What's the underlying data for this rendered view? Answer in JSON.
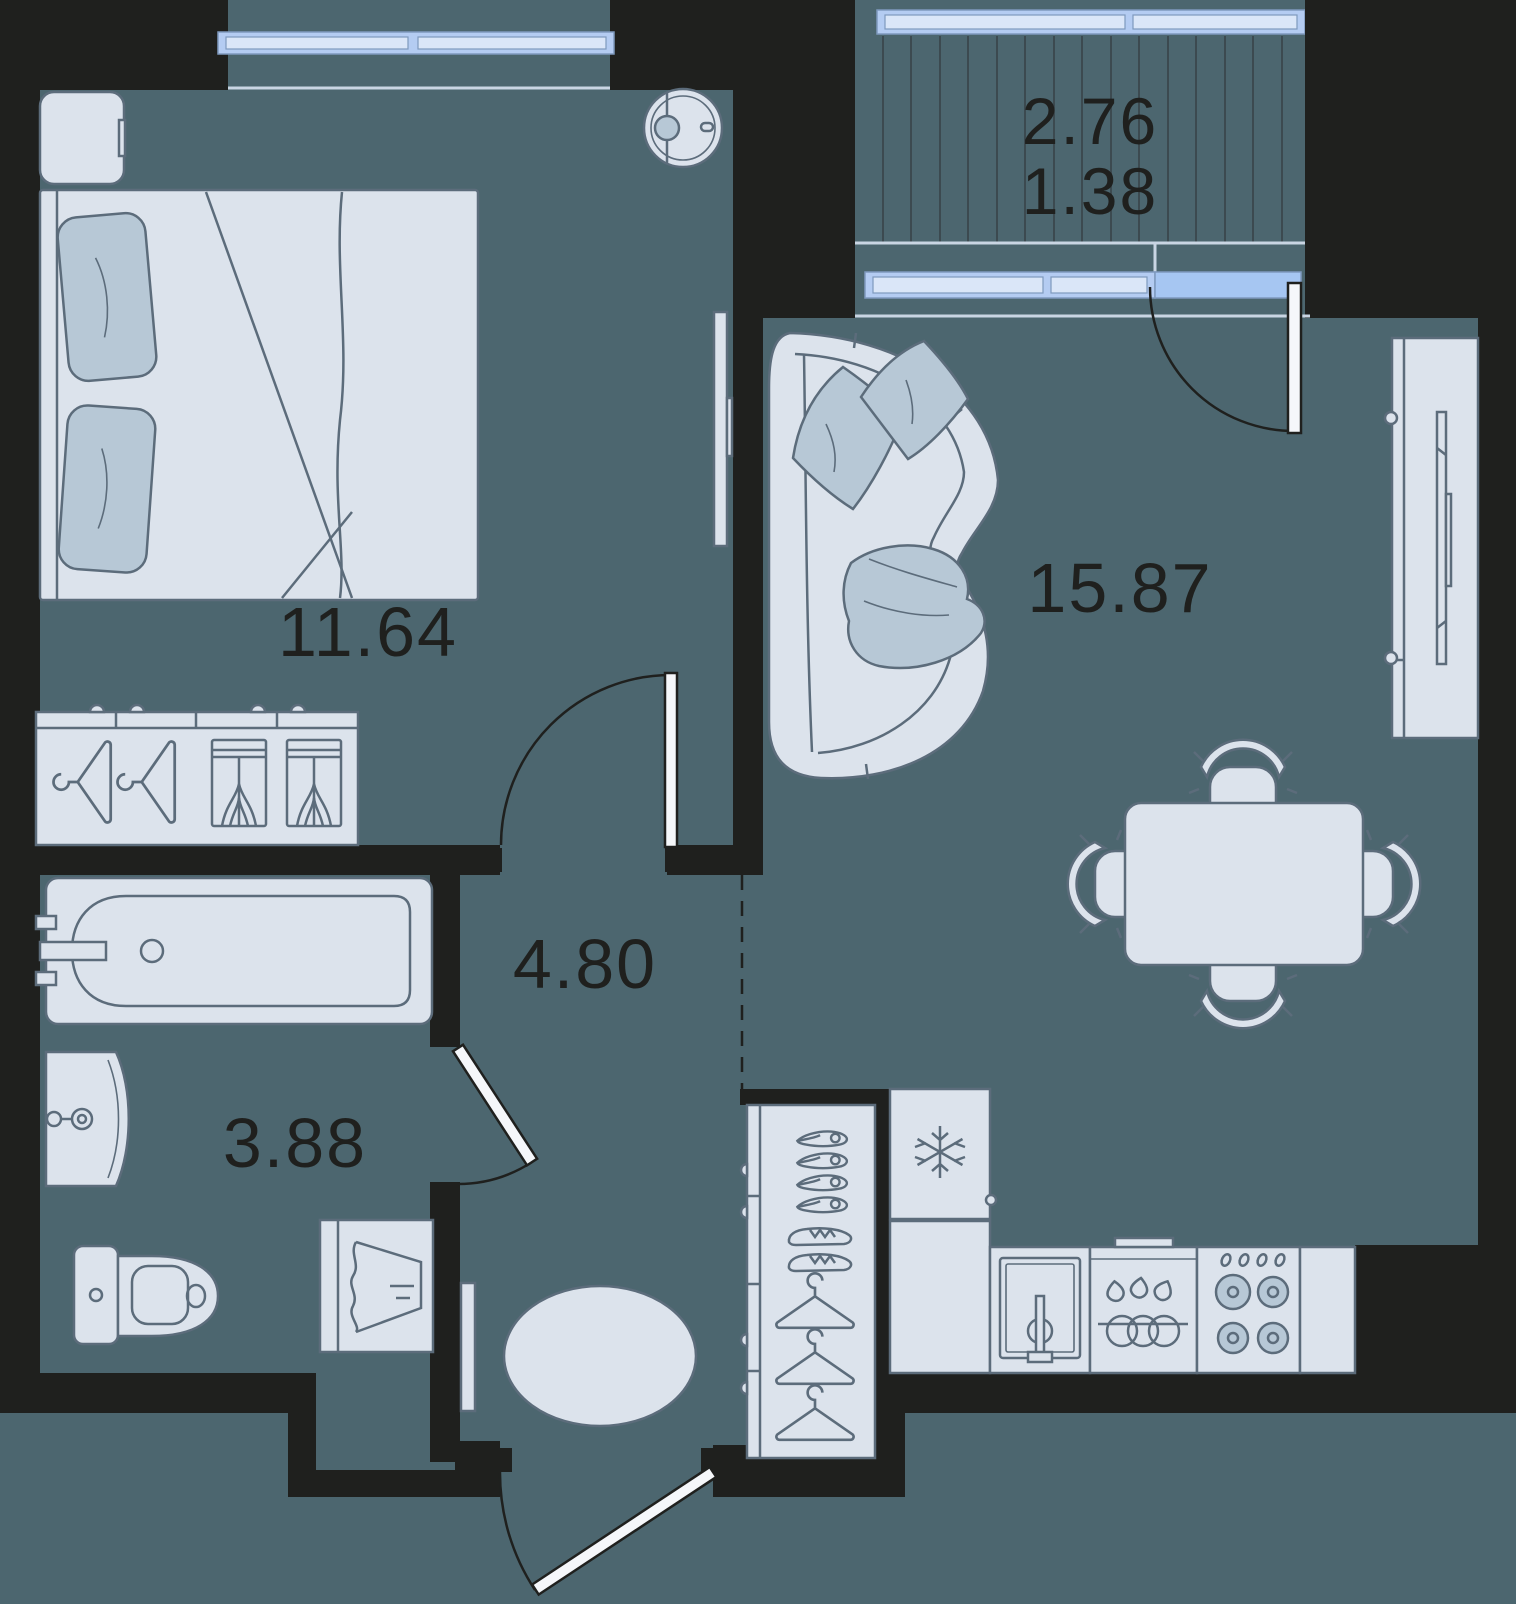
{
  "rooms": {
    "bedroom": {
      "label": "11.64"
    },
    "living": {
      "label": "15.87"
    },
    "hallway": {
      "label": "4.80"
    },
    "bathroom": {
      "label": "3.88"
    },
    "balcony": {
      "label_total": "2.76",
      "label_reduced": "1.38"
    }
  },
  "colors": {
    "floor_background": "#4C666F",
    "wall": "#1F201E",
    "furniture_fill": "#DCE3EC",
    "furniture_outline": "#5C6C7B",
    "textile_accent": "#B7C8D6",
    "window_glass": "#B4CCF2",
    "window_glass_light": "#DAE6F8",
    "balcony_door_glass": "#A6C6F2",
    "label_text": "#1F201E"
  },
  "furniture": [
    "double-bed",
    "nightstand",
    "wardrobe-with-hangers",
    "wall-tv-bedroom",
    "robot-vacuum",
    "curved-sofa",
    "tv-media-unit",
    "dining-table",
    "dining-chairs",
    "fridge",
    "kitchen-sink",
    "dishwasher",
    "stove",
    "hallway-shoe-closet",
    "entry-rug",
    "console-shelf",
    "bathtub",
    "wash-basin",
    "toilet",
    "washing-machine"
  ]
}
